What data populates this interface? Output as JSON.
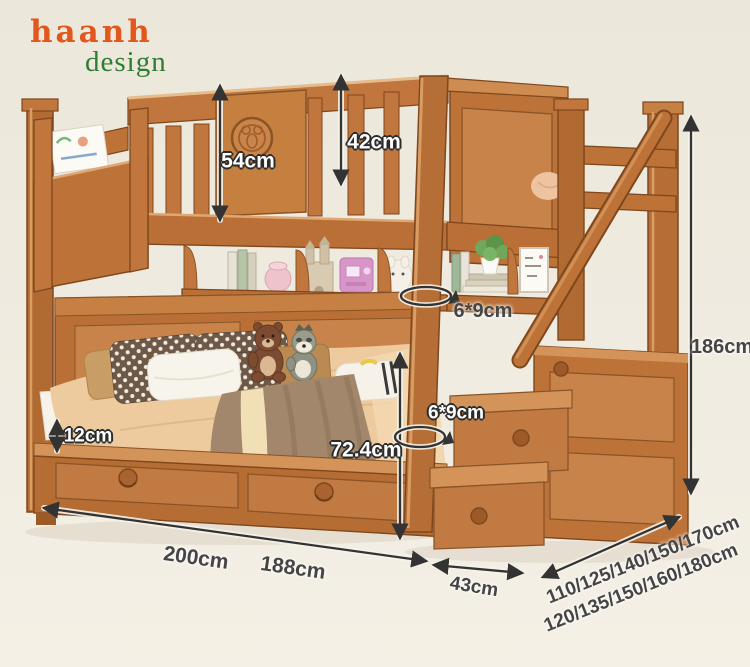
{
  "brand": {
    "name": "haanh",
    "tagline": "design"
  },
  "dimensions": {
    "rail_to_top": "54cm",
    "guard_above_mattress": "42cm",
    "post_cross_section_upper": "6*9cm",
    "post_cross_section_lower": "6*9cm",
    "bunk_clearance": "72.4cm",
    "mattress_edge_height": "12cm",
    "outer_length": "200cm",
    "inner_length": "188cm",
    "stair_depth": "43cm",
    "overall_height": "186cm",
    "upper_bed_width_options": "110/125/140/150/170cm",
    "lower_bed_width_options": "120/135/150/160/180cm"
  },
  "colors": {
    "brand_orange": "#e2571d",
    "brand_green": "#2f7d33",
    "wood": "#c07a40",
    "annotation_ink": "#454545",
    "background": "#efebe0"
  }
}
